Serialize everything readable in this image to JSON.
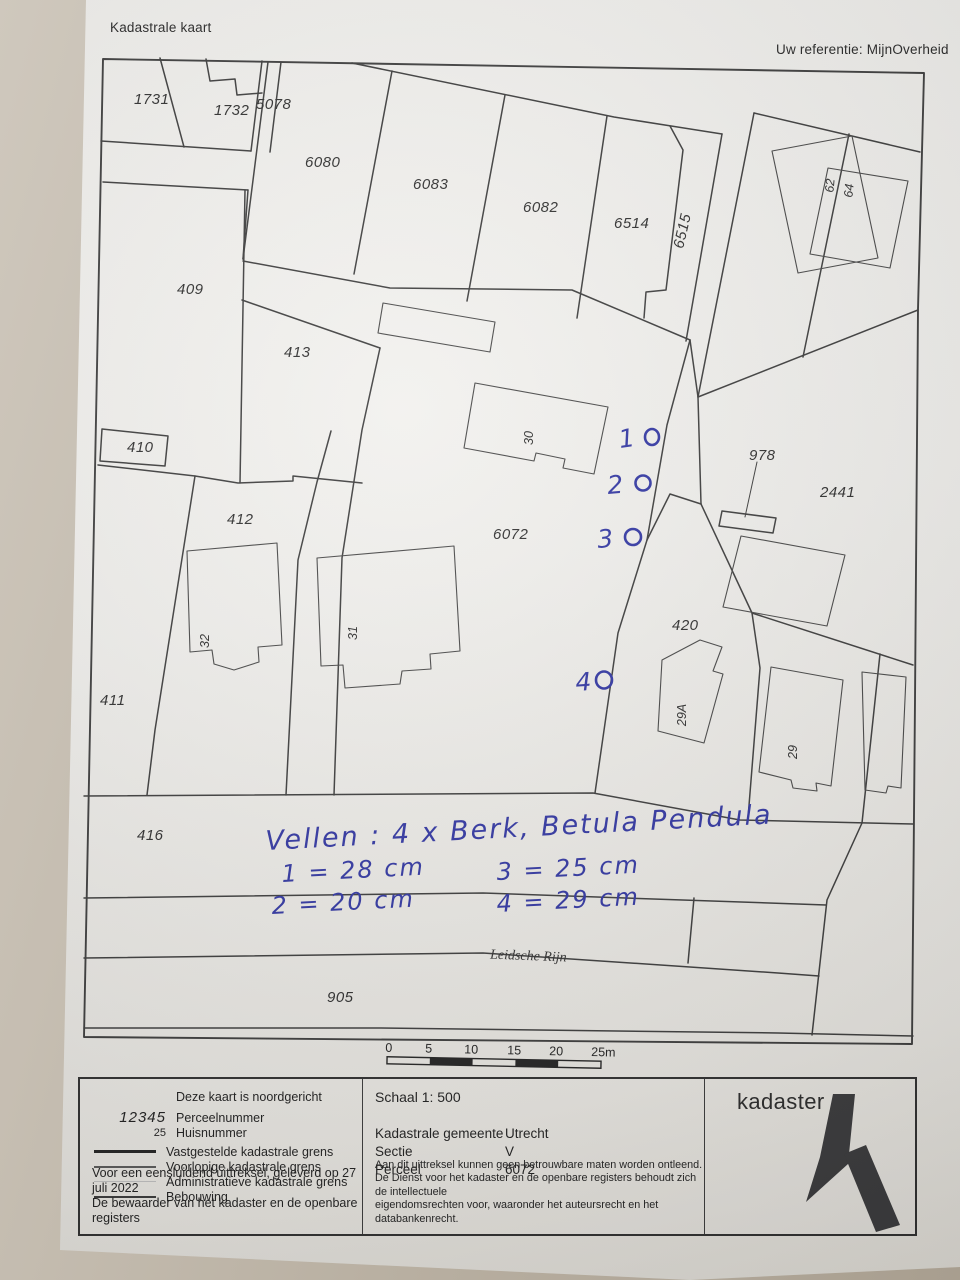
{
  "header": {
    "title": "Kadastrale kaart",
    "reference": "Uw referentie: MijnOverheid"
  },
  "map": {
    "parcels": [
      "1731",
      "1732",
      "5078",
      "6080",
      "6083",
      "6082",
      "6514",
      "6515",
      "409",
      "413",
      "410",
      "412",
      "411",
      "416",
      "6072",
      "978",
      "2441",
      "420",
      "905"
    ],
    "waterway": "Leidsche Rijn",
    "house_numbers": [
      "30",
      "31",
      "32",
      "29A",
      "29",
      "62",
      "64"
    ],
    "handwriting": {
      "ink_color": "#3136a3",
      "title_line": "Vellen : 4 x Berk, Betula Pendula",
      "measurements": [
        {
          "marker": "1",
          "text": "1 = 28 cm"
        },
        {
          "marker": "2",
          "text": "2 = 20 cm"
        },
        {
          "marker": "3",
          "text": "3 = 25 cm"
        },
        {
          "marker": "4",
          "text": "4 = 29 cm"
        }
      ],
      "tree_markers": [
        "1",
        "2",
        "3",
        "4"
      ]
    },
    "scale_bar": {
      "labels": [
        "0",
        "5",
        "10",
        "15",
        "20",
        "25m"
      ]
    }
  },
  "footer": {
    "legend": {
      "north_note": "Deze kaart is noordgericht",
      "parcel_sample": "12345",
      "parcel_label": "Perceelnummer",
      "house_sample": "25",
      "house_label": "Huisnummer",
      "line_items": [
        "Vastgestelde kadastrale grens",
        "Voorlopige kadastrale grens",
        "Administratieve kadastrale grens",
        "Bebouwing"
      ],
      "issued_line1": "Voor een eensluidend uittreksel, geleverd op 27 juli 2022",
      "issued_line2": "De bewaarder van het kadaster en de openbare registers"
    },
    "details": {
      "scale": "Schaal 1: 500",
      "rows": [
        {
          "label": "Kadastrale gemeente",
          "value": "Utrecht"
        },
        {
          "label": "Sectie",
          "value": "V"
        },
        {
          "label": "Perceel",
          "value": "6072"
        }
      ],
      "disclaimer": [
        "Aan dit uittreksel kunnen geen betrouwbare maten worden ontleend.",
        "De Dienst voor het kadaster en de openbare registers behoudt zich de intellectuele",
        "eigendomsrechten voor, waaronder het auteursrecht en het databankenrecht."
      ]
    },
    "brand": {
      "logo_text": "kadaster",
      "logo_color": "#3a3a3c"
    }
  }
}
